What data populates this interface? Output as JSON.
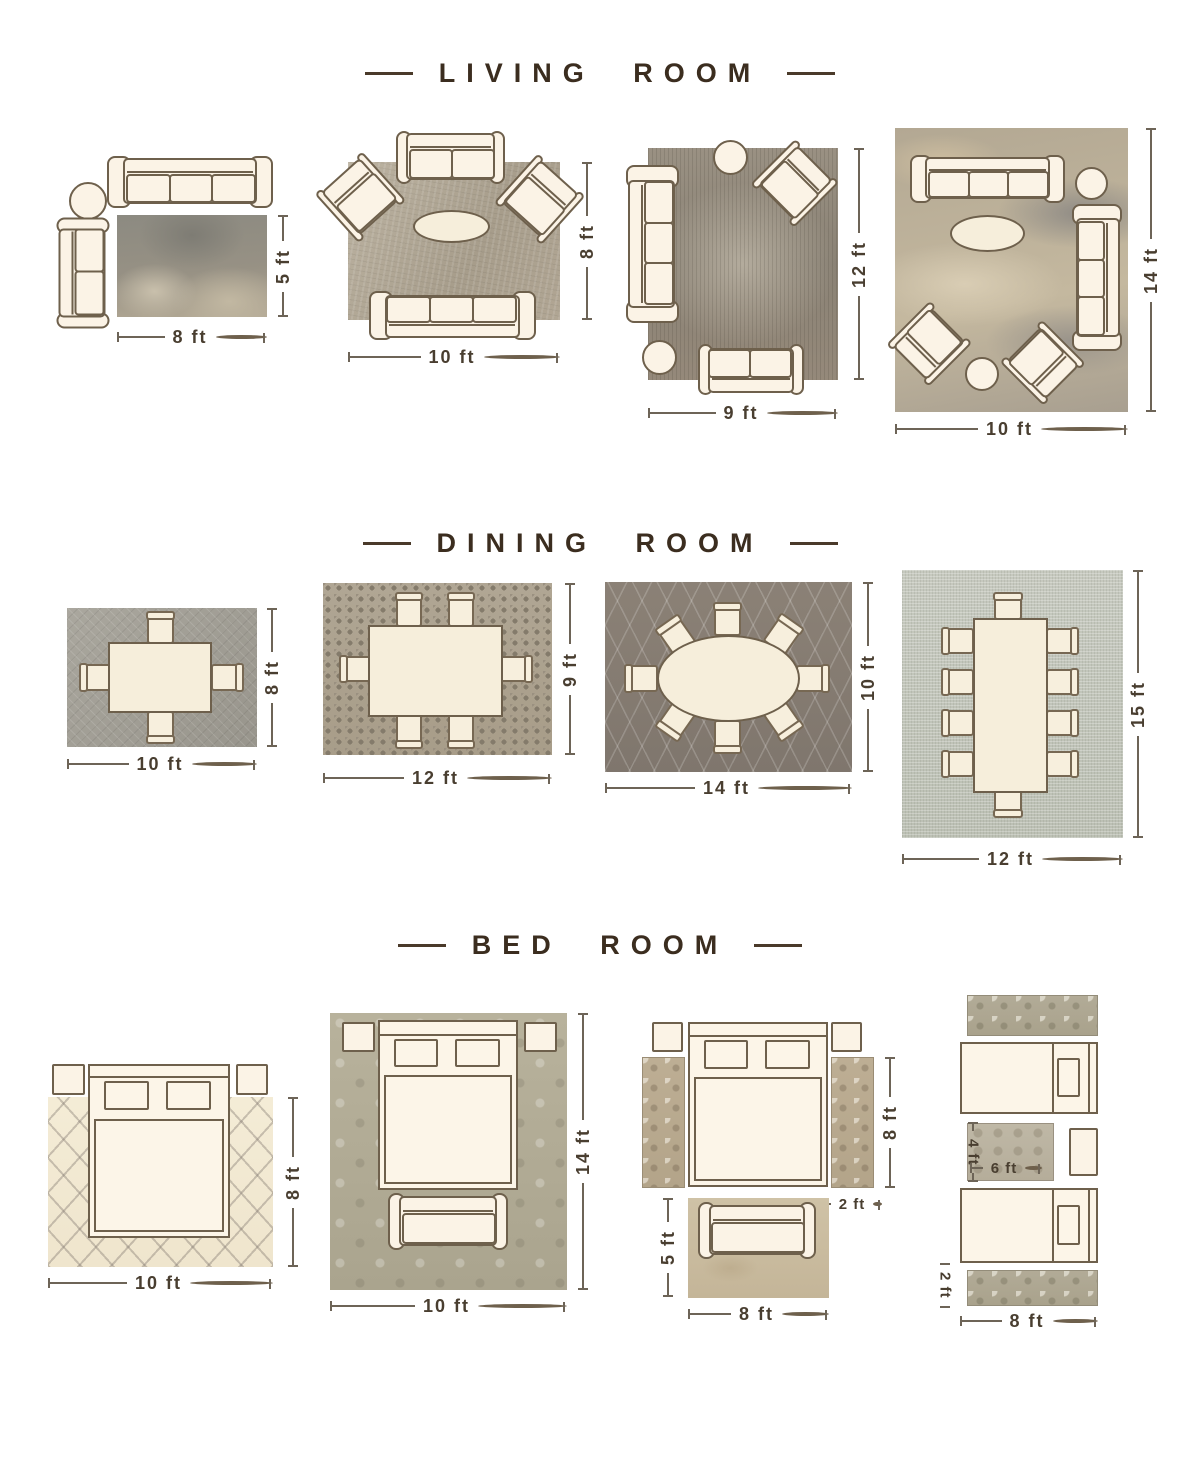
{
  "colors": {
    "background": "#ffffff",
    "heading_text": "#3b2d1f",
    "dimension_text": "#493e30",
    "dimension_line": "#6d6457",
    "furniture_fill": "#fbf3e6",
    "furniture_outline": "#6e604c"
  },
  "living_room": {
    "title": "LIVING ROOM",
    "layouts": [
      {
        "w": "8 ft",
        "h": "5 ft",
        "items": [
          "sofa",
          "loveseat",
          "round-side-table",
          "area-rug"
        ]
      },
      {
        "w": "10 ft",
        "h": "8 ft",
        "items": [
          "loveseat",
          "armchair",
          "armchair",
          "oval-coffee-table",
          "sofa",
          "area-rug"
        ]
      },
      {
        "w": "9 ft",
        "h": "12 ft",
        "items": [
          "round-side-table",
          "armchair",
          "sofa",
          "round-side-table",
          "loveseat",
          "area-rug"
        ]
      },
      {
        "w": "10 ft",
        "h": "14 ft",
        "items": [
          "sofa",
          "round-side-table",
          "sofa",
          "oval-coffee-table",
          "armchair",
          "round-side-table",
          "armchair",
          "area-rug"
        ]
      }
    ]
  },
  "dining_room": {
    "title": "DINING ROOM",
    "layouts": [
      {
        "w": "10 ft",
        "h": "8 ft",
        "items": [
          "dining-table",
          "4-chairs",
          "area-rug"
        ]
      },
      {
        "w": "12 ft",
        "h": "9 ft",
        "items": [
          "dining-table",
          "6-chairs",
          "area-rug"
        ]
      },
      {
        "w": "14 ft",
        "h": "10 ft",
        "items": [
          "oval-dining-table",
          "8-chairs",
          "area-rug"
        ]
      },
      {
        "w": "12 ft",
        "h": "15 ft",
        "items": [
          "long-dining-table",
          "10-chairs",
          "area-rug"
        ]
      }
    ]
  },
  "bed_room": {
    "title": "BED ROOM",
    "layouts": [
      {
        "w": "10 ft",
        "h": "8 ft",
        "items": [
          "bed",
          "nightstand",
          "nightstand",
          "area-rug"
        ]
      },
      {
        "w": "10 ft",
        "h": "14 ft",
        "items": [
          "bed",
          "nightstand",
          "nightstand",
          "bench",
          "area-rug"
        ]
      },
      {
        "bed_h": "8 ft",
        "runner_w": "2 ft",
        "rug_h": "5 ft",
        "rug_w": "8 ft",
        "items": [
          "bed",
          "nightstand",
          "nightstand",
          "runner-rug",
          "runner-rug",
          "bench",
          "accent-rug"
        ]
      },
      {
        "small_rug_h": "4 ft",
        "small_rug_w": "6 ft",
        "runner_h": "2 ft",
        "runner_w": "8 ft",
        "items": [
          "twin-bed",
          "twin-bed",
          "nightstand",
          "runner-rug",
          "runner-rug",
          "accent-rug"
        ]
      }
    ]
  }
}
